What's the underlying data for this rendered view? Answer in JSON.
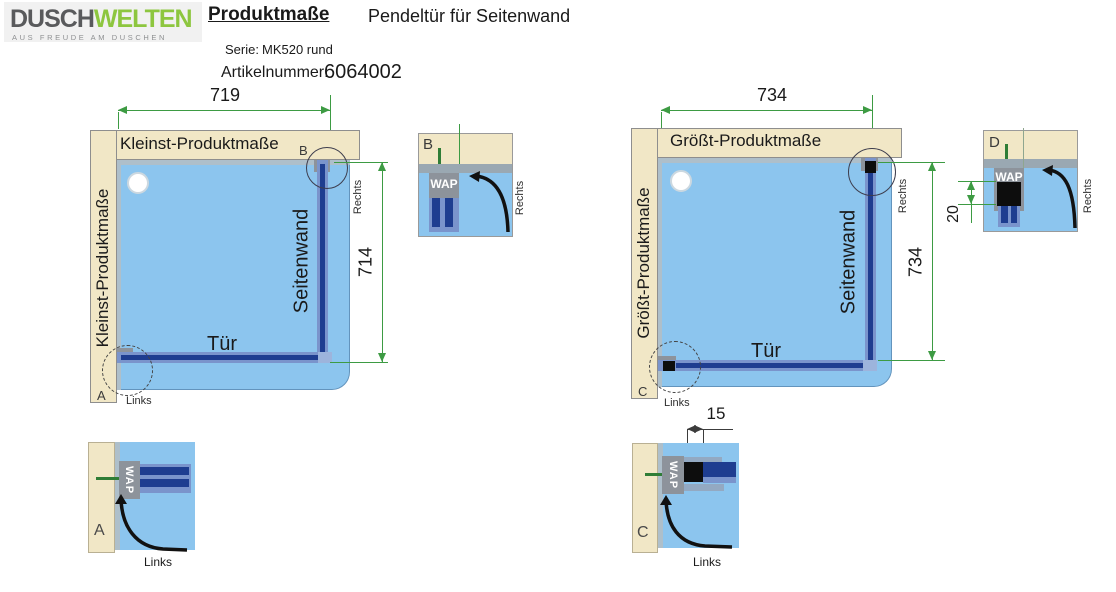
{
  "header": {
    "logo": {
      "text_primary": "DUSCH",
      "text_secondary": "WELTEN",
      "tagline": "AUS FREUDE AM DUSCHEN"
    },
    "doc_title": "Produktmaße",
    "doc_subtitle": "Pendeltür für Seitenwand",
    "serie_label": "Serie:",
    "serie_value": "MK520 rund",
    "artikel_label": "Artikelnummer:",
    "artikel_value": "6064002"
  },
  "colors": {
    "logo_green": "#8dc63f",
    "logo_gray": "#595a5c",
    "wall_beige": "#f1e7c6",
    "floor_blue": "#8cc5ee",
    "glass_navy": "#1e3d90",
    "glass_casing": "#7a94cc",
    "profile_gray": "#8d939b",
    "dimension_green": "#3d9b43",
    "swing_arrow_black": "#111111"
  },
  "diagram_left": {
    "top_title": "Kleinst-Produktmaße",
    "side_title": "Kleinst-Produktmaße",
    "width_dim": "719",
    "height_dim": "714",
    "door_label": "Tür",
    "sidewall_label": "Seitenwand",
    "hinge_side_label": "Rechts",
    "handle_side_label": "Links",
    "detail_marker_top": "B",
    "detail_marker_bottom": "A"
  },
  "diagram_right": {
    "top_title": "Größt-Produktmaße",
    "side_title": "Größt-Produktmaße",
    "width_dim": "734",
    "height_dim": "734",
    "door_label": "Tür",
    "sidewall_label": "Seitenwand",
    "hinge_side_label": "Rechts",
    "handle_side_label": "Links",
    "detail_marker_bottom": "C"
  },
  "detail_a": {
    "label": "A",
    "profile": "WAP",
    "side": "Links"
  },
  "detail_b": {
    "label": "B",
    "profile": "WAP",
    "side": "Rechts"
  },
  "detail_c": {
    "label": "C",
    "profile": "WAP",
    "side": "Links",
    "gap_dim": "15"
  },
  "detail_d": {
    "label": "D",
    "profile": "WAP",
    "side": "Rechts",
    "adjust_dim": "20"
  }
}
